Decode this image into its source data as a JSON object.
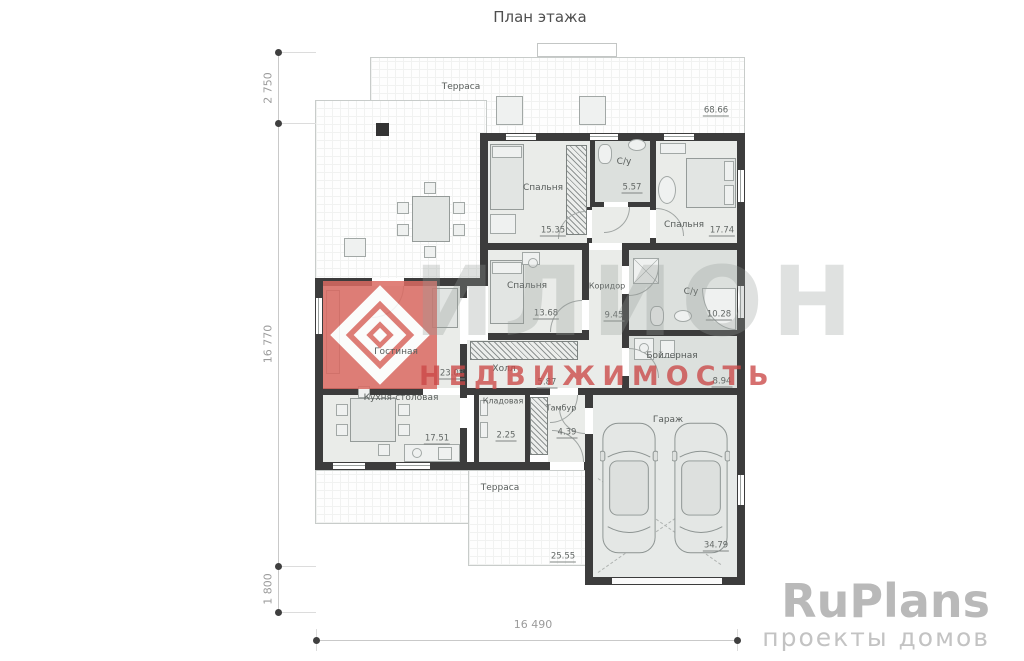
{
  "title": "План этажа",
  "rooms": {
    "terrace_top": {
      "name": "Терраса"
    },
    "bedroom1": {
      "name": "Спальня",
      "area": "15.35"
    },
    "bath1": {
      "name": "С/у",
      "area": "5.57"
    },
    "bedroom2": {
      "name": "Спальня",
      "area": "17.74"
    },
    "bedroom3": {
      "name": "Спальня",
      "area": "13.68"
    },
    "corridor": {
      "name": "Коридор",
      "area": "9.45"
    },
    "bath2": {
      "name": "С/у",
      "area": "10.28"
    },
    "living": {
      "name": "Гостиная",
      "area": "23.08"
    },
    "hall": {
      "name": "Холл",
      "area": "5.87"
    },
    "boiler": {
      "name": "Бойлерная",
      "area": "8.94"
    },
    "kitchen": {
      "name": "Кухня-столовая",
      "area": "17.51"
    },
    "pantry": {
      "name": "Кладовая",
      "area": "2.25"
    },
    "vestibule": {
      "name": "Тамбур",
      "area": "4.39"
    },
    "garage": {
      "name": "Гараж",
      "area": "34.79"
    },
    "terrace_bottom": {
      "name": "Терраса",
      "area": "25.55"
    }
  },
  "dimensions": {
    "left_top": "2 750",
    "left_main": "16 770",
    "left_bottom": "1 800",
    "bottom": "16 490",
    "plan_area": "68.66"
  },
  "watermark": {
    "brand": "ИЛИОН",
    "line": "НЕДВИЖИМОСТЬ"
  },
  "branding": {
    "logo": "RuPlans",
    "tagline": "проекты домов"
  },
  "colors": {
    "wall": "#3c3c3c",
    "room_fill": "#eaece9",
    "wet_fill": "#dce0dd",
    "watermark_red": "#cb4846",
    "logo_red": "#db6a62",
    "brand_gray": "#b9b9b9"
  }
}
